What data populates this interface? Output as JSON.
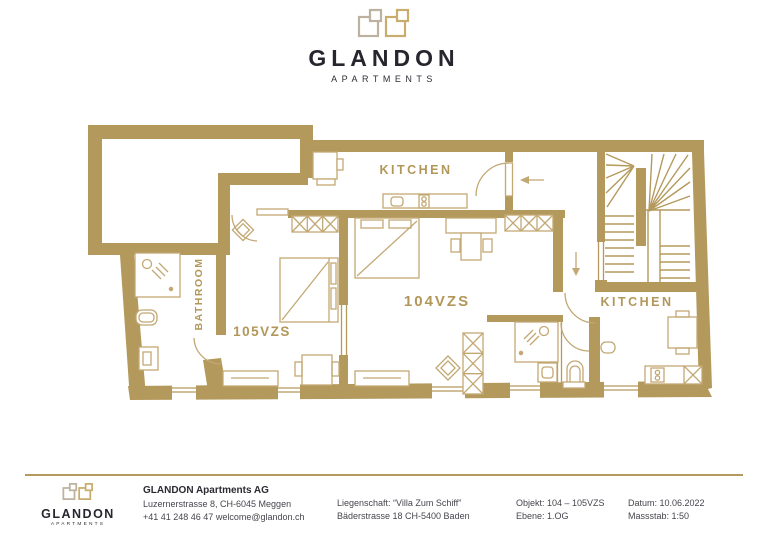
{
  "brand": {
    "name": "GLANDON",
    "subtitle": "APARTMENTS"
  },
  "plan": {
    "rooms": {
      "kitchen_top": "KITCHEN",
      "kitchen_right": "KITCHEN",
      "bathroom": "BATHROOM",
      "unit_104": "104VZS",
      "unit_105": "105VZS"
    }
  },
  "footer": {
    "company": {
      "name": "GLANDON Apartments AG",
      "address": "Luzernerstrasse 8, CH-6045 Meggen",
      "contact": "+41 41 248 46 47 welcome@glandon.ch"
    },
    "property": {
      "line1": "Liegenschaft: “Villa Zum Schiff”",
      "line2": "Bäderstrasse 18  CH-5400 Baden"
    },
    "object": {
      "line1": "Objekt: 104 – 105VZS",
      "line2": "Ebene: 1.OG"
    },
    "meta": {
      "line1": "Datum: 10.06.2022",
      "line2": "Massstab: 1:50"
    }
  },
  "colors": {
    "wall_gold": "#b4995c",
    "line_gold": "#c2a873",
    "label_gold": "#b2975a",
    "text_dark": "#27262e",
    "logo_gray": "#bdb2a0",
    "logo_gold": "#c9ad6e"
  }
}
